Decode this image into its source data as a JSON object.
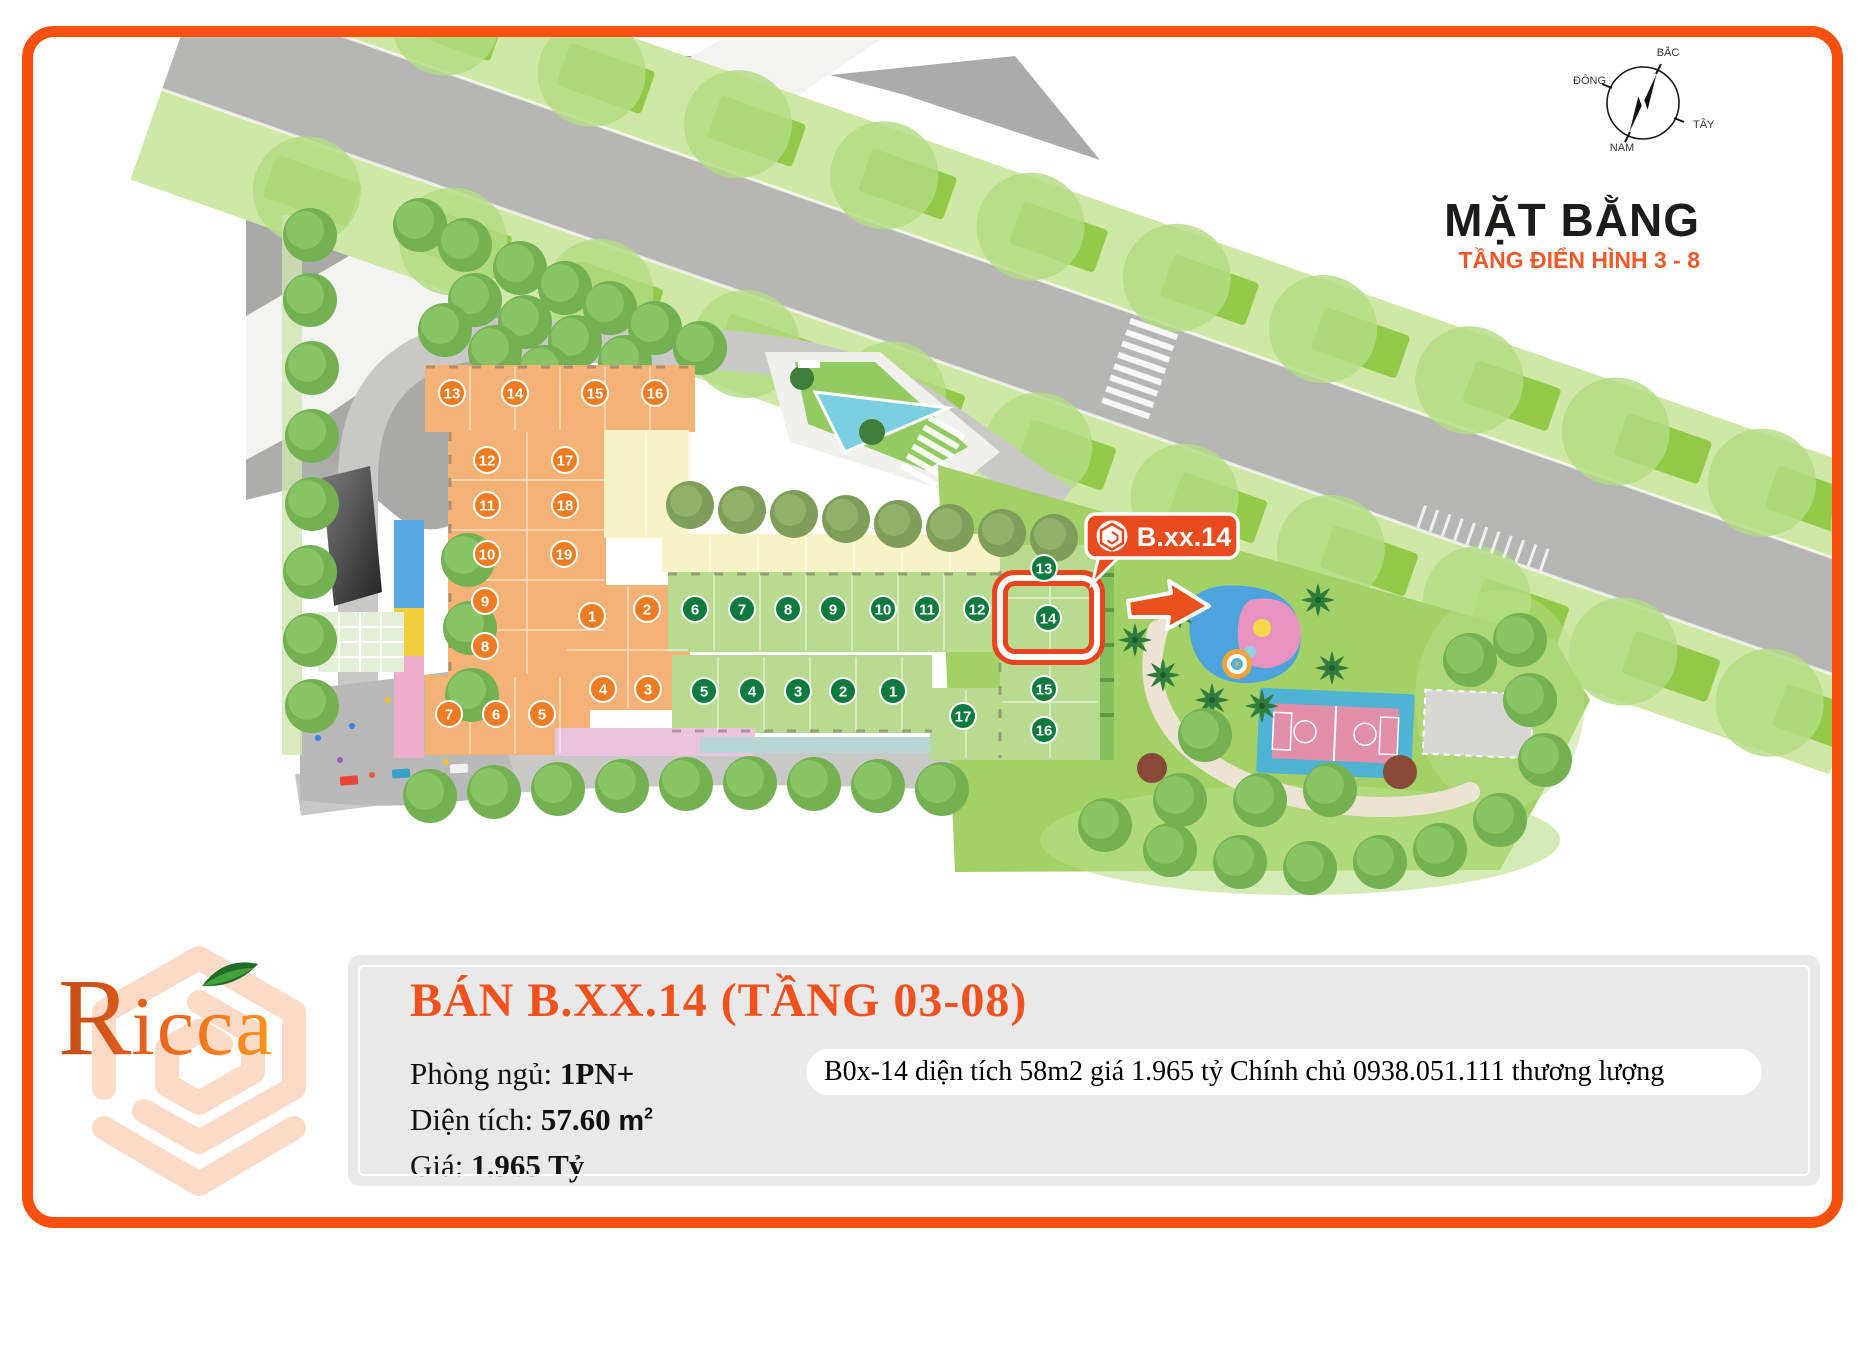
{
  "map": {
    "title": "MẶT BẰNG",
    "subtitle": "TẦNG ĐIỂN HÌNH 3 - 8",
    "compass": {
      "n": "BẮC",
      "e": "ĐÔNG",
      "w": "TÂY",
      "s": "NAM"
    },
    "callout_label": "B.xx.14",
    "orange_units": [
      "1",
      "2",
      "3",
      "4",
      "5",
      "6",
      "7",
      "8",
      "9",
      "10",
      "11",
      "12",
      "13",
      "14",
      "15",
      "16",
      "17",
      "18",
      "19"
    ],
    "green_units": [
      "1",
      "2",
      "3",
      "4",
      "5",
      "6",
      "7",
      "8",
      "9",
      "10",
      "11",
      "12",
      "13",
      "14",
      "15",
      "16",
      "17"
    ]
  },
  "colors": {
    "page_border": "#f8510f",
    "accent_title": "#f1511d",
    "subtitle_orange": "#f05a28",
    "badge_orange": "#ed7c23",
    "badge_green": "#0f7a3e",
    "highlight_red": "#e8451f",
    "building_orange": "#f5b277",
    "building_green": "#b8db90",
    "building_yellow": "#f7f3c6",
    "panel_gray": "#e9e9ea"
  },
  "logo": {
    "wordmark_initial": "R",
    "wordmark_rest": "icca"
  },
  "panel": {
    "title": "BÁN B.XX.14 (TẦNG 03-08)",
    "bedrooms_label": "Phòng ngủ: ",
    "bedrooms_value": "1PN+",
    "area_label": "Diện tích: ",
    "area_value": "57.60 ",
    "area_unit_base": "m",
    "area_unit_sup": "2",
    "price_label": "Giá: ",
    "price_value": "1.965 Tỷ",
    "note": "B0x-14 diện tích 58m2 giá 1.965 tỷ Chính chủ 0938.051.111 thương lượng"
  }
}
